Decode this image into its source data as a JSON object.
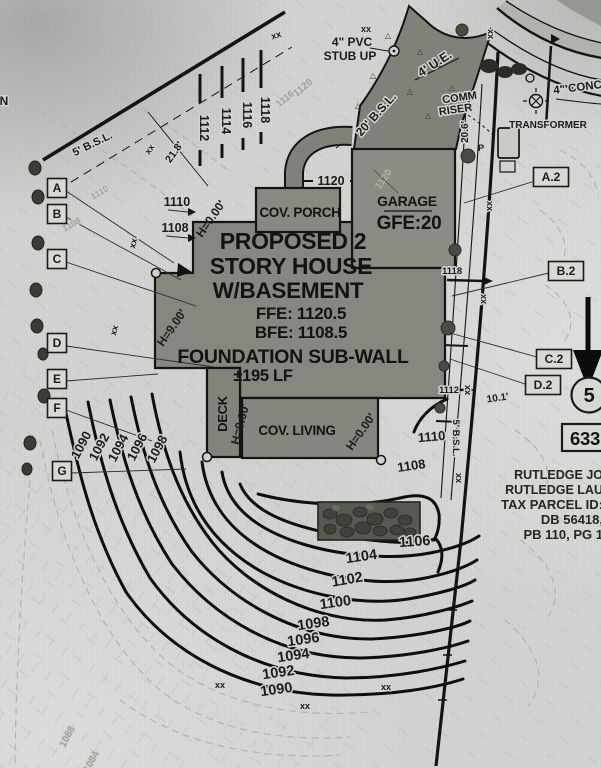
{
  "colors": {
    "paper": "#d2d3d0",
    "ink": "#1c1c1a",
    "house_fill": "#85887e",
    "driveway_fill": "#7f8278",
    "stone_fill": "#565a50",
    "faint": "#9fa19c"
  },
  "house": {
    "title1": "PROPOSED 2",
    "title2": "STORY HOUSE",
    "title3": "W/BASEMENT",
    "ffe": "FFE: 1120.5",
    "bfe": "BFE: 1108.5",
    "foundation1": "FOUNDATION SUB-WALL",
    "foundation2": "±195 LF",
    "cov_porch": "COV. PORCH",
    "garage": "GARAGE",
    "gfe": "GFE:20",
    "deck": "DECK",
    "cov_living": "COV. LIVING"
  },
  "owner": {
    "line1": "RUTLEDGE JO",
    "line2": "RUTLEDGE LAU",
    "line3": "TAX PARCEL ID:",
    "line4": "DB 56418,",
    "line5": "PB 110, PG 1"
  },
  "lot": {
    "number": "5",
    "address": "633"
  },
  "markers_left": [
    {
      "label": "A",
      "x": 57,
      "y": 188
    },
    {
      "label": "B",
      "x": 57,
      "y": 214
    },
    {
      "label": "C",
      "x": 57,
      "y": 259
    },
    {
      "label": "D",
      "x": 57,
      "y": 343
    },
    {
      "label": "E",
      "x": 57,
      "y": 379
    },
    {
      "label": "F",
      "x": 57,
      "y": 408
    },
    {
      "label": "G",
      "x": 62,
      "y": 471
    }
  ],
  "markers_right": [
    {
      "label": "A.2",
      "x": 551,
      "y": 177
    },
    {
      "label": "B.2",
      "x": 566,
      "y": 271
    },
    {
      "label": "C.2",
      "x": 554,
      "y": 359
    },
    {
      "label": "D.2",
      "x": 543,
      "y": 385
    }
  ],
  "annotations": [
    {
      "n": "pvc-stubup-label-1",
      "t": "4\" PVC",
      "x": 352,
      "y": 46,
      "s": 12
    },
    {
      "n": "pvc-stubup-label-2",
      "t": "STUB UP",
      "x": 350,
      "y": 60,
      "s": 12
    },
    {
      "n": "utility-easement-label",
      "t": "4' U.E.",
      "x": 437,
      "y": 67,
      "s": 12.5,
      "r": -33
    },
    {
      "n": "comm-riser-label-1",
      "t": "COMM",
      "x": 460,
      "y": 101,
      "s": 11,
      "r": -8
    },
    {
      "n": "comm-riser-label-2",
      "t": "RISER",
      "x": 456,
      "y": 113,
      "s": 11,
      "r": -8
    },
    {
      "n": "transformer-label",
      "t": "TRANSFORMER",
      "x": 548,
      "y": 128,
      "s": 10
    },
    {
      "n": "conc-walk-label",
      "t": "4\" CONC",
      "x": 578,
      "y": 91,
      "s": 11.5,
      "r": -7
    },
    {
      "n": "bsl-20-label",
      "t": "20' B.S.L.",
      "x": 379,
      "y": 117,
      "s": 12,
      "r": -48
    },
    {
      "n": "dim-20-6",
      "t": "20.6'",
      "x": 468,
      "y": 132,
      "s": 10,
      "r": -90
    },
    {
      "n": "power-pole-label",
      "t": "P",
      "x": 481,
      "y": 151,
      "s": 9.5,
      "h": 0
    },
    {
      "n": "bsl-5-left-label",
      "t": "5' B.S.L.",
      "x": 94,
      "y": 147,
      "s": 11,
      "r": -26
    },
    {
      "n": "dim-21-8",
      "t": "21.8'",
      "x": 177,
      "y": 154,
      "s": 10.5,
      "r": -55
    },
    {
      "n": "edge-letter-n",
      "t": "N",
      "x": 4,
      "y": 105,
      "s": 12
    },
    {
      "n": "height-000-a",
      "t": "H=0.00'",
      "x": 214,
      "y": 221,
      "s": 12,
      "r": -55,
      "h": 0
    },
    {
      "n": "height-000-b",
      "t": "H=0.00'",
      "x": 364,
      "y": 434,
      "s": 12,
      "r": -55,
      "h": 0
    },
    {
      "n": "height-900-a",
      "t": "H=9.00'",
      "x": 175,
      "y": 330,
      "s": 12,
      "r": -55,
      "h": 0
    },
    {
      "n": "height-900-b",
      "t": "H=9.00'",
      "x": 244,
      "y": 425,
      "s": 12,
      "r": -75,
      "h": 0
    },
    {
      "n": "contour-1110-left",
      "t": "1110",
      "x": 177,
      "y": 206,
      "s": 12.5
    },
    {
      "n": "contour-1108-left",
      "t": "1108",
      "x": 175,
      "y": 232,
      "s": 12.5
    },
    {
      "n": "contour-1120-court",
      "t": "1120",
      "x": 331,
      "y": 185,
      "s": 12.5
    },
    {
      "n": "contour-1112-top",
      "t": "1112",
      "x": 200,
      "y": 128,
      "s": 12.5,
      "r": 90
    },
    {
      "n": "contour-1114-top",
      "t": "1114",
      "x": 222,
      "y": 121,
      "s": 12.5,
      "r": 90
    },
    {
      "n": "contour-1116-top",
      "t": "1116",
      "x": 243,
      "y": 115,
      "s": 12.5,
      "r": 90
    },
    {
      "n": "contour-1118-top",
      "t": "1118",
      "x": 261,
      "y": 110,
      "s": 12.5,
      "r": 90
    },
    {
      "n": "contour-1118-right",
      "t": "1118",
      "x": 452,
      "y": 274,
      "s": 9.5
    },
    {
      "n": "contour-1112-right",
      "t": "1112",
      "x": 449,
      "y": 393,
      "s": 9.5
    },
    {
      "n": "bsl-5-right-label",
      "t": "5' B.S.L.",
      "x": 453,
      "y": 438,
      "s": 9.5,
      "r": 90
    },
    {
      "n": "dim-10-1",
      "t": "10.1'",
      "x": 498,
      "y": 401,
      "s": 10,
      "r": -8
    },
    {
      "n": "contour-1110-bottom",
      "t": "1110",
      "x": 432,
      "y": 441,
      "s": 13,
      "r": -5
    },
    {
      "n": "contour-1108-bottom",
      "t": "1108",
      "x": 412,
      "y": 470,
      "s": 13,
      "r": -8
    },
    {
      "n": "contour-1106",
      "t": "1106",
      "x": 415,
      "y": 546,
      "s": 14.5,
      "r": -4
    },
    {
      "n": "contour-1104",
      "t": "1104",
      "x": 362,
      "y": 561,
      "s": 14.5,
      "r": -8
    },
    {
      "n": "contour-1102",
      "t": "1102",
      "x": 348,
      "y": 584,
      "s": 14.5,
      "r": -10
    },
    {
      "n": "contour-1100",
      "t": "1100",
      "x": 336,
      "y": 607,
      "s": 14.5,
      "r": -8
    },
    {
      "n": "contour-1098",
      "t": "1098",
      "x": 314,
      "y": 628,
      "s": 14.5,
      "r": -8
    },
    {
      "n": "contour-1096",
      "t": "1096",
      "x": 304,
      "y": 644,
      "s": 14.5,
      "r": -8
    },
    {
      "n": "contour-1094",
      "t": "1094",
      "x": 294,
      "y": 660,
      "s": 14.5,
      "r": -8
    },
    {
      "n": "contour-1092",
      "t": "1092",
      "x": 279,
      "y": 677,
      "s": 14.5,
      "r": -8
    },
    {
      "n": "contour-1090",
      "t": "1090",
      "x": 277,
      "y": 694,
      "s": 14.5,
      "r": -8
    },
    {
      "n": "contour-1090-rot",
      "t": "1090",
      "x": 85,
      "y": 447,
      "s": 13,
      "r": -62
    },
    {
      "n": "contour-1092-rot",
      "t": "1092",
      "x": 103,
      "y": 449,
      "s": 13,
      "r": -62
    },
    {
      "n": "contour-1094-rot",
      "t": "1094",
      "x": 122,
      "y": 450,
      "s": 13,
      "r": -62
    },
    {
      "n": "contour-1096-rot",
      "t": "1096",
      "x": 141,
      "y": 449,
      "s": 13,
      "r": -62
    },
    {
      "n": "contour-1098-rot",
      "t": "1098",
      "x": 161,
      "y": 451,
      "s": 13,
      "r": -62
    },
    {
      "n": "contour-1120-faint",
      "t": "1120",
      "x": 305,
      "y": 90,
      "s": 10,
      "r": -40,
      "c": "faint"
    },
    {
      "n": "contour-1116-faint",
      "t": "1116",
      "x": 287,
      "y": 101,
      "s": 9.5,
      "r": -40,
      "c": "faint"
    },
    {
      "n": "contour-1120-garage-faint",
      "t": "1120",
      "x": 386,
      "y": 181,
      "s": 10,
      "r": -55,
      "c": "ondark"
    },
    {
      "n": "contour-1110-faint",
      "t": "1110",
      "x": 101,
      "y": 195,
      "s": 9,
      "r": -30,
      "c": "faint"
    },
    {
      "n": "contour-1108-faint",
      "t": "1108",
      "x": 73,
      "y": 227,
      "s": 9,
      "r": -30,
      "c": "faint"
    },
    {
      "n": "contour-1088-faint",
      "t": "1088",
      "x": 70,
      "y": 738,
      "s": 10,
      "r": -62,
      "c": "faint"
    },
    {
      "n": "contour-1084-faint",
      "t": "1084",
      "x": 94,
      "y": 763,
      "s": 10,
      "r": -62,
      "c": "faint"
    },
    {
      "n": "silt-fence-xx",
      "t": "xx",
      "x": 366,
      "y": 32,
      "s": 9
    },
    {
      "n": "silt-fence-xx",
      "t": "xx",
      "x": 277,
      "y": 38,
      "s": 9,
      "r": -18
    },
    {
      "n": "silt-fence-xx",
      "t": "xx",
      "x": 152,
      "y": 151,
      "s": 9,
      "r": -55
    },
    {
      "n": "silt-fence-xx",
      "t": "xx",
      "x": 136,
      "y": 244,
      "s": 9,
      "r": -75
    },
    {
      "n": "silt-fence-xx",
      "t": "xx",
      "x": 117,
      "y": 331,
      "s": 9,
      "r": -75
    },
    {
      "n": "silt-fence-xx",
      "t": "xx",
      "x": 493,
      "y": 34,
      "s": 9,
      "r": -90
    },
    {
      "n": "silt-fence-xx",
      "t": "xx",
      "x": 492,
      "y": 206,
      "s": 9,
      "r": -90
    },
    {
      "n": "silt-fence-xx",
      "t": "xx",
      "x": 486,
      "y": 299,
      "s": 9,
      "r": -90
    },
    {
      "n": "silt-fence-xx",
      "t": "xx",
      "x": 470,
      "y": 390,
      "s": 9,
      "r": -90
    },
    {
      "n": "silt-fence-xx",
      "t": "xx",
      "x": 461,
      "y": 478,
      "s": 9,
      "r": -90
    },
    {
      "n": "silt-fence-xx",
      "t": "xx",
      "x": 220,
      "y": 688,
      "s": 9
    },
    {
      "n": "silt-fence-xx",
      "t": "xx",
      "x": 305,
      "y": 709,
      "s": 9
    },
    {
      "n": "silt-fence-xx",
      "t": "xx",
      "x": 386,
      "y": 690,
      "s": 9
    },
    {
      "n": "concrete-triangle",
      "t": "△",
      "x": 388,
      "y": 38,
      "s": 8,
      "c": "tri"
    },
    {
      "n": "concrete-triangle",
      "t": "△",
      "x": 420,
      "y": 54,
      "s": 8,
      "c": "tri"
    },
    {
      "n": "concrete-triangle",
      "t": "△",
      "x": 373,
      "y": 78,
      "s": 8,
      "c": "tri"
    },
    {
      "n": "concrete-triangle",
      "t": "△",
      "x": 410,
      "y": 94,
      "s": 8,
      "c": "tri"
    },
    {
      "n": "concrete-triangle",
      "t": "△",
      "x": 438,
      "y": 66,
      "s": 8,
      "c": "tri"
    },
    {
      "n": "concrete-triangle",
      "t": "△",
      "x": 358,
      "y": 108,
      "s": 8,
      "c": "tri"
    },
    {
      "n": "concrete-triangle",
      "t": "△",
      "x": 428,
      "y": 118,
      "s": 8,
      "c": "tri"
    },
    {
      "n": "concrete-triangle",
      "t": "△",
      "x": 452,
      "y": 90,
      "s": 8,
      "c": "tri"
    }
  ]
}
